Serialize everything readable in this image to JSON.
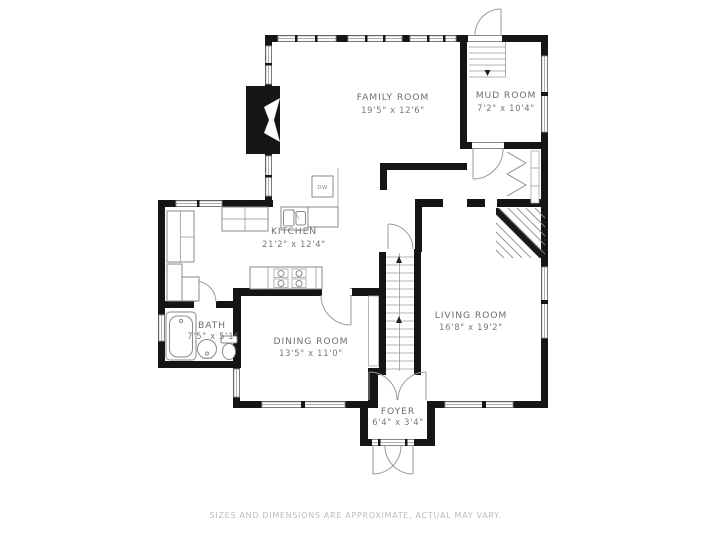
{
  "rooms": [
    {
      "id": "family-room",
      "name": "FAMILY ROOM",
      "dims": "19'5\" x 12'6\""
    },
    {
      "id": "mud-room",
      "name": "MUD ROOM",
      "dims": "7'2\" x 10'4\""
    },
    {
      "id": "kitchen",
      "name": "KITCHEN",
      "dims": "21'2\" x 12'4\""
    },
    {
      "id": "living-room",
      "name": "LIVING ROOM",
      "dims": "16'8\" x 19'2\""
    },
    {
      "id": "bath",
      "name": "BATH",
      "dims": "7'5\" x 5'1\""
    },
    {
      "id": "dining-room",
      "name": "DINING ROOM",
      "dims": "13'5\" x 11'0\""
    },
    {
      "id": "foyer",
      "name": "FOYER",
      "dims": "6'4\" x 3'4\""
    }
  ],
  "appliances": {
    "dishwasher_label": "DW"
  },
  "footer": {
    "disclaimer": "SIZES AND DIMENSIONS ARE APPROXIMATE, ACTUAL MAY VARY."
  },
  "colors": {
    "background": "#ffffff",
    "wall": "#151515",
    "thin_line": "#8f8f8f",
    "label_text": "#6e6e6e",
    "disclaimer_text": "#b9bdc4"
  }
}
